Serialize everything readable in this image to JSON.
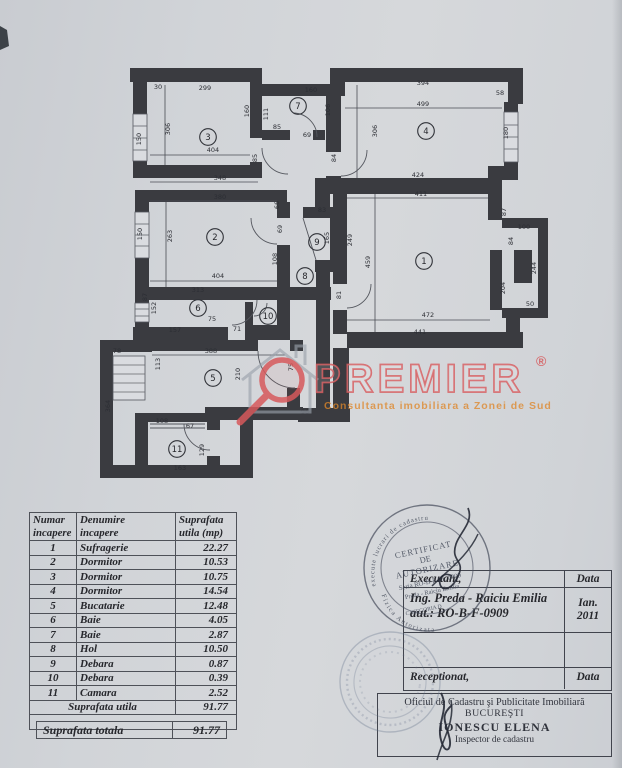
{
  "watermark": {
    "brand": "PREMIER",
    "reg": "®",
    "tagline": "Consultanta imobiliara a Zonei de Sud"
  },
  "plan": {
    "rooms": [
      {
        "n": "1",
        "x": 424,
        "y": 261
      },
      {
        "n": "2",
        "x": 215,
        "y": 237
      },
      {
        "n": "3",
        "x": 208,
        "y": 137
      },
      {
        "n": "4",
        "x": 426,
        "y": 131
      },
      {
        "n": "5",
        "x": 213,
        "y": 378
      },
      {
        "n": "6",
        "x": 198,
        "y": 308
      },
      {
        "n": "7",
        "x": 298,
        "y": 106
      },
      {
        "n": "8",
        "x": 305,
        "y": 276
      },
      {
        "n": "9",
        "x": 317,
        "y": 242
      },
      {
        "n": "10",
        "x": 268,
        "y": 316
      },
      {
        "n": "11",
        "x": 177,
        "y": 449
      }
    ],
    "dims": [
      {
        "t": "299",
        "x": 205,
        "y": 90
      },
      {
        "t": "30",
        "x": 158,
        "y": 89
      },
      {
        "t": "404",
        "x": 213,
        "y": 152
      },
      {
        "t": "306",
        "x": 170,
        "y": 129,
        "v": true
      },
      {
        "t": "150",
        "x": 141,
        "y": 139,
        "v": true
      },
      {
        "t": "160",
        "x": 249,
        "y": 111,
        "v": true
      },
      {
        "t": "160",
        "x": 311,
        "y": 92
      },
      {
        "t": "111",
        "x": 268,
        "y": 114,
        "v": true
      },
      {
        "t": "106",
        "x": 330,
        "y": 110,
        "v": true
      },
      {
        "t": "85",
        "x": 277,
        "y": 129
      },
      {
        "t": "69",
        "x": 307,
        "y": 137
      },
      {
        "t": "394",
        "x": 423,
        "y": 85
      },
      {
        "t": "499",
        "x": 423,
        "y": 106
      },
      {
        "t": "58",
        "x": 500,
        "y": 95
      },
      {
        "t": "306",
        "x": 377,
        "y": 131,
        "v": true
      },
      {
        "t": "180",
        "x": 508,
        "y": 133,
        "v": true
      },
      {
        "t": "424",
        "x": 418,
        "y": 177
      },
      {
        "t": "411",
        "x": 421,
        "y": 196
      },
      {
        "t": "85",
        "x": 257,
        "y": 158,
        "v": true
      },
      {
        "t": "84",
        "x": 336,
        "y": 158,
        "v": true
      },
      {
        "t": "348",
        "x": 220,
        "y": 180
      },
      {
        "t": "380",
        "x": 220,
        "y": 199
      },
      {
        "t": "263",
        "x": 172,
        "y": 236,
        "v": true
      },
      {
        "t": "150",
        "x": 142,
        "y": 234,
        "v": true
      },
      {
        "t": "404",
        "x": 218,
        "y": 278
      },
      {
        "t": "66",
        "x": 279,
        "y": 205,
        "v": true
      },
      {
        "t": "69",
        "x": 282,
        "y": 229,
        "v": true
      },
      {
        "t": "108",
        "x": 277,
        "y": 259,
        "v": true
      },
      {
        "t": "313",
        "x": 198,
        "y": 292
      },
      {
        "t": "83",
        "x": 322,
        "y": 212
      },
      {
        "t": "165",
        "x": 329,
        "y": 238,
        "v": true
      },
      {
        "t": "249",
        "x": 352,
        "y": 240,
        "v": true
      },
      {
        "t": "459",
        "x": 370,
        "y": 262,
        "v": true
      },
      {
        "t": "81",
        "x": 341,
        "y": 295,
        "v": true
      },
      {
        "t": "472",
        "x": 428,
        "y": 317
      },
      {
        "t": "441",
        "x": 420,
        "y": 334
      },
      {
        "t": "100",
        "x": 524,
        "y": 229
      },
      {
        "t": "84",
        "x": 513,
        "y": 241,
        "v": true
      },
      {
        "t": "87",
        "x": 506,
        "y": 212,
        "v": true
      },
      {
        "t": "204",
        "x": 505,
        "y": 288,
        "v": true
      },
      {
        "t": "244",
        "x": 536,
        "y": 268,
        "v": true
      },
      {
        "t": "50",
        "x": 530,
        "y": 306
      },
      {
        "t": "157",
        "x": 175,
        "y": 332
      },
      {
        "t": "71",
        "x": 237,
        "y": 331
      },
      {
        "t": "152",
        "x": 156,
        "y": 308,
        "v": true
      },
      {
        "t": "87",
        "x": 147,
        "y": 297,
        "v": true
      },
      {
        "t": "75",
        "x": 212,
        "y": 321
      },
      {
        "t": "388",
        "x": 211,
        "y": 353
      },
      {
        "t": "113",
        "x": 160,
        "y": 364,
        "v": true
      },
      {
        "t": "78",
        "x": 117,
        "y": 353
      },
      {
        "t": "364",
        "x": 110,
        "y": 406,
        "v": true
      },
      {
        "t": "210",
        "x": 240,
        "y": 374,
        "v": true
      },
      {
        "t": "75",
        "x": 293,
        "y": 367,
        "v": true
      },
      {
        "t": "96",
        "x": 305,
        "y": 414
      },
      {
        "t": "108",
        "x": 162,
        "y": 423
      },
      {
        "t": "67",
        "x": 190,
        "y": 428
      },
      {
        "t": "129",
        "x": 204,
        "y": 450,
        "v": true
      },
      {
        "t": "163",
        "x": 180,
        "y": 470
      }
    ]
  },
  "area_table": {
    "headers": [
      "Numar\nincapere",
      "Denumire\nincapere",
      "Suprafata\nutila (mp)"
    ],
    "rows": [
      [
        "1",
        "Sufragerie",
        "22.27"
      ],
      [
        "2",
        "Dormitor",
        "10.53"
      ],
      [
        "3",
        "Dormitor",
        "10.75"
      ],
      [
        "4",
        "Dormitor",
        "14.54"
      ],
      [
        "5",
        "Bucatarie",
        "12.48"
      ],
      [
        "6",
        "Baie",
        "4.05"
      ],
      [
        "7",
        "Baie",
        "2.87"
      ],
      [
        "8",
        "Hol",
        "10.50"
      ],
      [
        "9",
        "Debara",
        "0.87"
      ],
      [
        "10",
        "Debara",
        "0.39"
      ],
      [
        "11",
        "Camara",
        "2.52"
      ],
      [
        "Suprafata utila",
        "91.77"
      ]
    ],
    "total_label": "Suprafata totala",
    "total_value": "91.77"
  },
  "exec_table": {
    "executant_label": "Executant,",
    "data_label": "Data",
    "name": "Ing. Preda - Raiciu Emilia",
    "aut": "aut.: RO-B-F-0909",
    "date_line1": "Ian.",
    "date_line2": "2011",
    "receptionat_label": "Receptionat,",
    "data_label2": "Data"
  },
  "office": {
    "line1": "Oficiul de Cadastru şi Publicitate Imobiliară",
    "line2": "BUCUREŞTI",
    "line3": "IONESCU ELENA",
    "line4": "Inspector de cadastru"
  },
  "stamp": {
    "edge_top": "Autorizata de ANCPI sa execute lucrari de cadastru",
    "edge_bottom": "Persoana Fizica Autorizata",
    "line1": "CERTIFICAT",
    "line2": "DE",
    "line3": "AUTORIZARE",
    "line4": "Seria RO-B-F Nr. 0909",
    "line5": "Preda - Raiciu Emilia",
    "category": "CATEGORIA D"
  }
}
